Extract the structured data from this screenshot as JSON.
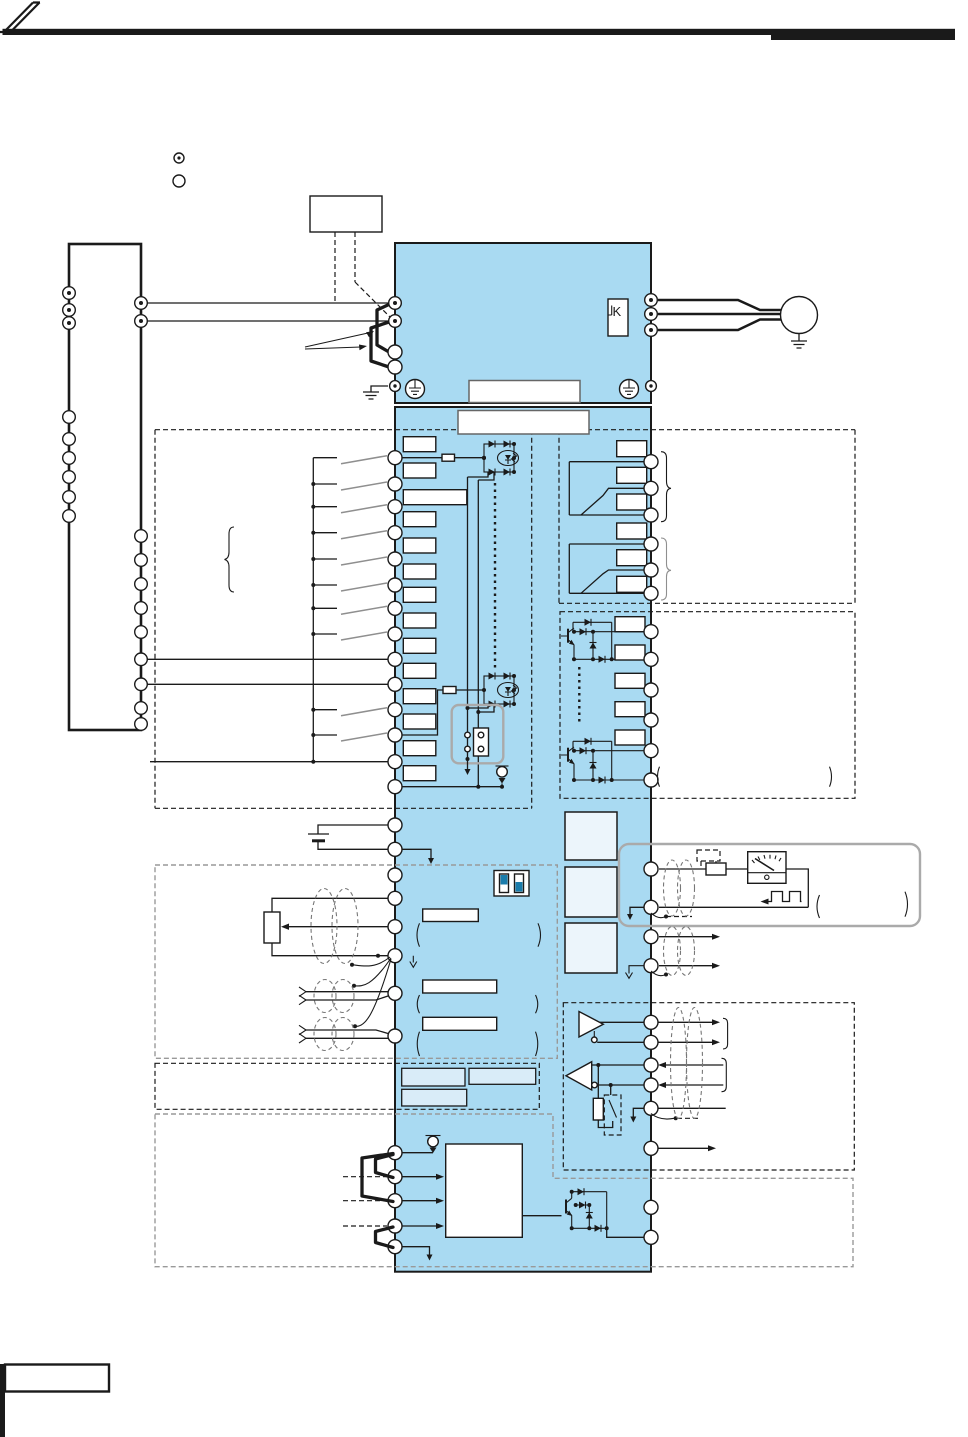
{
  "document": {
    "kind": "inverter-terminal-connection-diagram",
    "page_text_visible": false
  },
  "labels": {
    "jk": "K"
  },
  "colors": {
    "ink": "#1a1a1a",
    "white": "#ffffff",
    "band": "#a9daf2",
    "lightBox": "#d9ecf8",
    "paleBox": "#ecf5fb",
    "dipBlue": "#1a7cab",
    "gray": "#999999",
    "blade": "#8f8f8f",
    "roundedBorder": "#aaaaaa"
  },
  "icons": {
    "brand-logo": "double-stroke-slash",
    "motor-icon": "circle-with-earth",
    "earth-ground-icon": "three-bar-ground",
    "protective-earth-icon": "circle-enclosed-ground",
    "battery-icon": "long-short-plates",
    "potentiometer-icon": "rect-with-wiper-arrow",
    "optocoupler-icon": "diode-bridge-with-led",
    "dip-switch-icon": "two-slide-switch",
    "relay-contact-icon": "pivot-blade-contact",
    "open-collector-icon": "npn-with-diodes",
    "rs485-driver-icon": "triangle-right",
    "rs485-receiver-icon": "triangle-left",
    "terminating-resistor-icon": "resistor-with-switch",
    "analog-meter-icon": "needle-gauge",
    "pulse-output-icon": "square-wave",
    "shielded-cable-icon": "dashed-ellipse-pair",
    "current-source-icon": "circle-with-diode",
    "jumper-link-icon": "thick-u-link",
    "sink-source-connector-icon": "two-pin-plug"
  },
  "counts": {
    "supply_box_left_terminals": 9,
    "supply_box_right_terminals": 11,
    "control_input_terminals": 14,
    "relay_output_terminals": 6,
    "open_collector_terminals": 6,
    "analog_input_terminals": 8,
    "monitor_output_terminals": 4,
    "serial_terminals": 6,
    "safety_left_terminals": 5,
    "safety_right_terminals": 2
  }
}
